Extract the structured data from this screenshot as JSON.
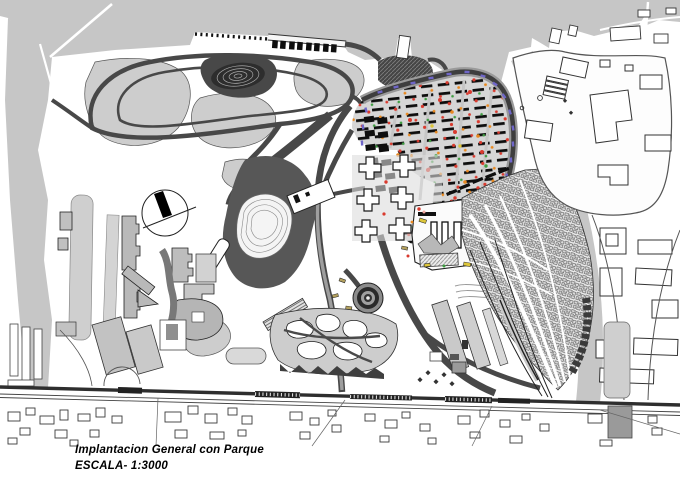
{
  "caption": {
    "title": "Implantacion General con Parque",
    "scale": "ESCALA- 1:3000"
  },
  "plan": {
    "type": "architectural master plan",
    "features": {
      "water_label": "water",
      "park_label": "park",
      "housing_label": "housing-rows",
      "old_town_label": "dense-fabric",
      "railway_label": "railway"
    }
  },
  "colors": {
    "water": "#c6c6c6",
    "meadow": "#cdcdcd",
    "pathdark": "#484848",
    "ground": "#d6d6d6",
    "building": "#0e0e0e",
    "graybldg": "#b9b9b9",
    "red": "#d93a2e",
    "orange": "#e8881f",
    "green": "#3f9e42",
    "yellow": "#ddc63a",
    "purple": "#6f66c8",
    "olive": "#b3a05e",
    "rail": "#2e2e2e"
  }
}
